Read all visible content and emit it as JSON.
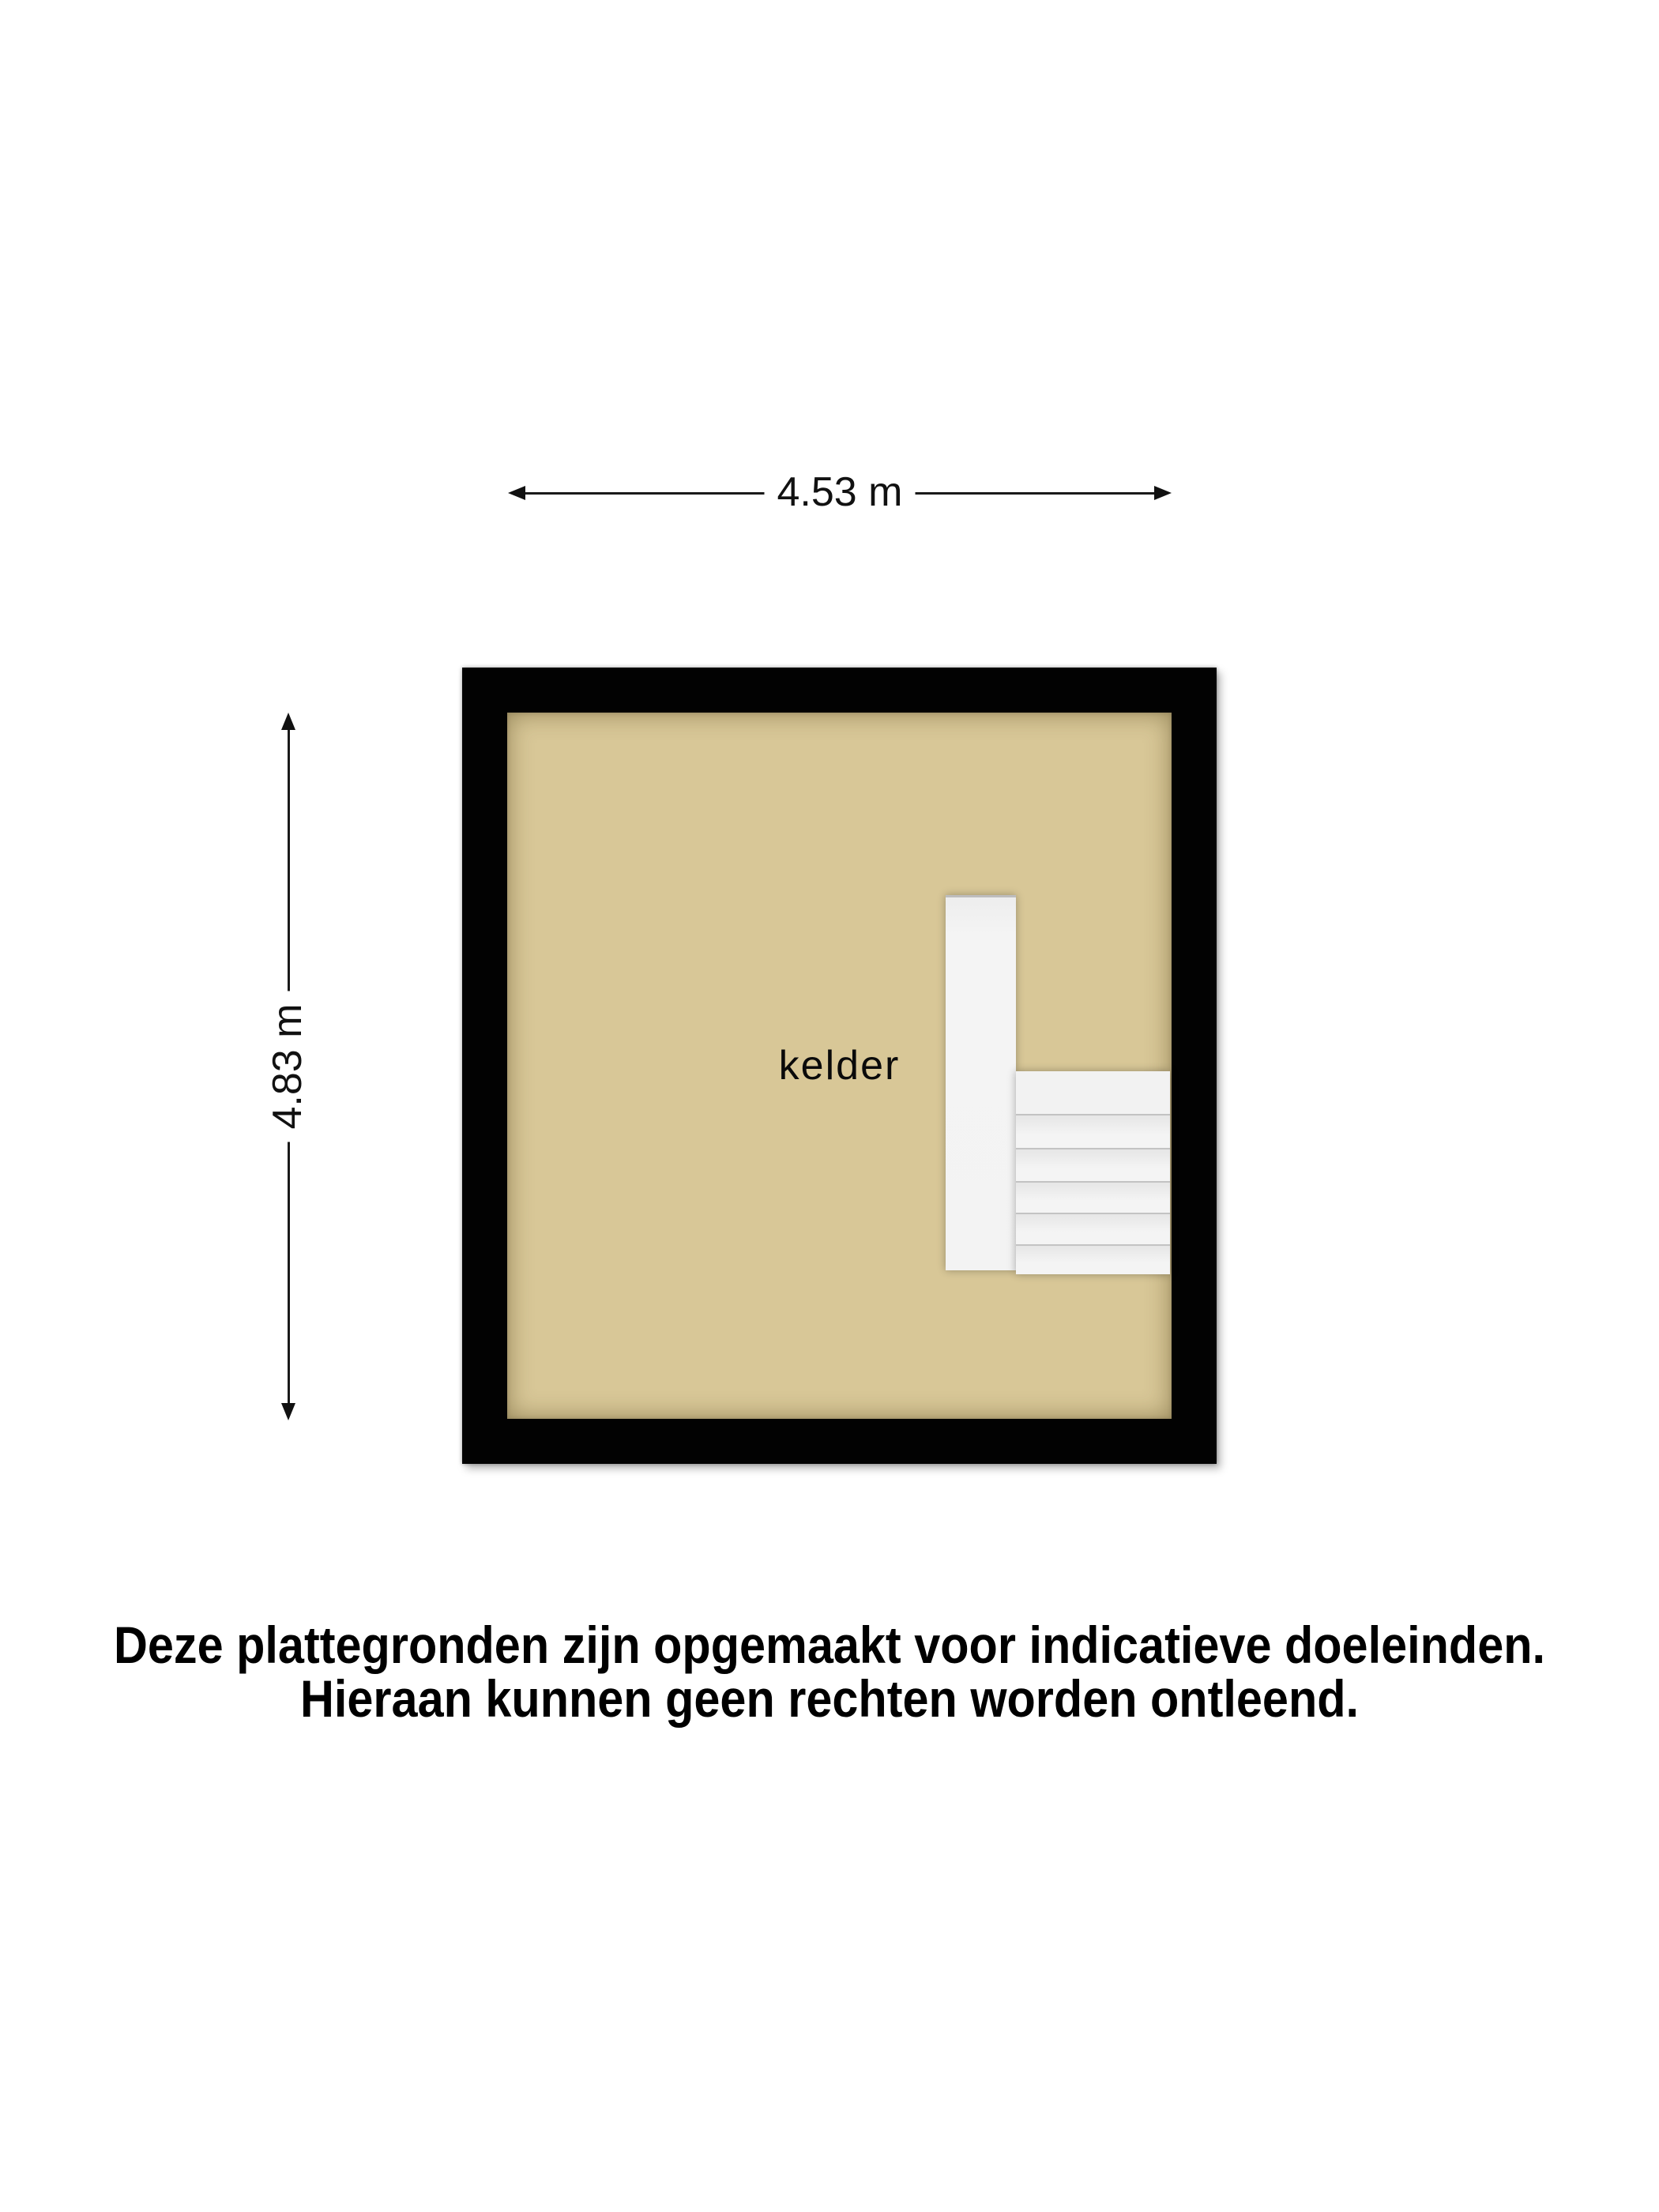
{
  "floor_plan": {
    "room": {
      "label": "kelder"
    },
    "dimensions": {
      "width_label": "4.53 m",
      "height_label": "4.83 m"
    },
    "stairs": {
      "tread_count": 6
    },
    "colors": {
      "background": "#ffffff",
      "wall": "#020202",
      "floor": "#d8c797",
      "stairs": "#f3f3f3",
      "dimension_text": "#111111"
    }
  },
  "disclaimer": {
    "line1": "Deze plattegronden zijn opgemaakt voor indicatieve doeleinden.",
    "line2": "Hieraan kunnen geen rechten worden ontleend."
  }
}
